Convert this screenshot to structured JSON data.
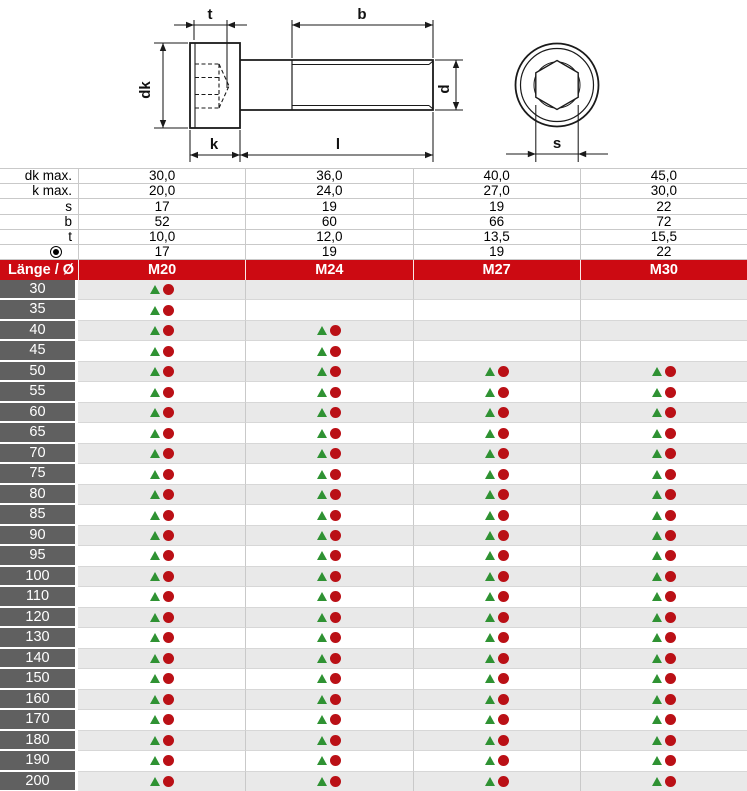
{
  "diagram": {
    "labels": {
      "t": "t",
      "b": "b",
      "dk": "dk",
      "k": "k",
      "l": "l",
      "d": "d",
      "s": "s"
    }
  },
  "table": {
    "corner_label": "Länge / Ø",
    "columns": [
      "M20",
      "M24",
      "M27",
      "M30"
    ],
    "spec_rows": [
      {
        "label": "dk max.",
        "values": [
          "30,0",
          "36,0",
          "40,0",
          "45,0"
        ]
      },
      {
        "label": "k max.",
        "values": [
          "20,0",
          "24,0",
          "27,0",
          "30,0"
        ]
      },
      {
        "label": "s",
        "values": [
          "17",
          "19",
          "19",
          "22"
        ]
      },
      {
        "label": "b",
        "values": [
          "52",
          "60",
          "66",
          "72"
        ]
      },
      {
        "label": "t",
        "values": [
          "10,0",
          "12,0",
          "13,5",
          "15,5"
        ]
      },
      {
        "label": "",
        "symbol": "fisheye-icon",
        "values": [
          "17",
          "19",
          "19",
          "22"
        ]
      }
    ],
    "length_rows": [
      {
        "length": "30",
        "available": [
          1,
          0,
          0,
          0
        ]
      },
      {
        "length": "35",
        "available": [
          1,
          0,
          0,
          0
        ]
      },
      {
        "length": "40",
        "available": [
          1,
          1,
          0,
          0
        ]
      },
      {
        "length": "45",
        "available": [
          1,
          1,
          0,
          0
        ]
      },
      {
        "length": "50",
        "available": [
          1,
          1,
          1,
          1
        ]
      },
      {
        "length": "55",
        "available": [
          1,
          1,
          1,
          1
        ]
      },
      {
        "length": "60",
        "available": [
          1,
          1,
          1,
          1
        ]
      },
      {
        "length": "65",
        "available": [
          1,
          1,
          1,
          1
        ]
      },
      {
        "length": "70",
        "available": [
          1,
          1,
          1,
          1
        ]
      },
      {
        "length": "75",
        "available": [
          1,
          1,
          1,
          1
        ]
      },
      {
        "length": "80",
        "available": [
          1,
          1,
          1,
          1
        ]
      },
      {
        "length": "85",
        "available": [
          1,
          1,
          1,
          1
        ]
      },
      {
        "length": "90",
        "available": [
          1,
          1,
          1,
          1
        ]
      },
      {
        "length": "95",
        "available": [
          1,
          1,
          1,
          1
        ]
      },
      {
        "length": "100",
        "available": [
          1,
          1,
          1,
          1
        ]
      },
      {
        "length": "110",
        "available": [
          1,
          1,
          1,
          1
        ]
      },
      {
        "length": "120",
        "available": [
          1,
          1,
          1,
          1
        ]
      },
      {
        "length": "130",
        "available": [
          1,
          1,
          1,
          1
        ]
      },
      {
        "length": "140",
        "available": [
          1,
          1,
          1,
          1
        ]
      },
      {
        "length": "150",
        "available": [
          1,
          1,
          1,
          1
        ]
      },
      {
        "length": "160",
        "available": [
          1,
          1,
          1,
          1
        ]
      },
      {
        "length": "170",
        "available": [
          1,
          1,
          1,
          1
        ]
      },
      {
        "length": "180",
        "available": [
          1,
          1,
          1,
          1
        ]
      },
      {
        "length": "190",
        "available": [
          1,
          1,
          1,
          1
        ]
      },
      {
        "length": "200",
        "available": [
          1,
          1,
          1,
          1
        ]
      }
    ]
  },
  "colors": {
    "header_red": "#cc0a12",
    "header_text": "#ffffff",
    "row_label_bg": "#606060",
    "row_label_text": "#ffffff",
    "row_alt_bg": "#e9e9e9",
    "grid_line": "#c9c9c9",
    "marker_green": "#2f9233",
    "marker_red": "#ba1016",
    "drawing_line": "#1a1a1a"
  }
}
